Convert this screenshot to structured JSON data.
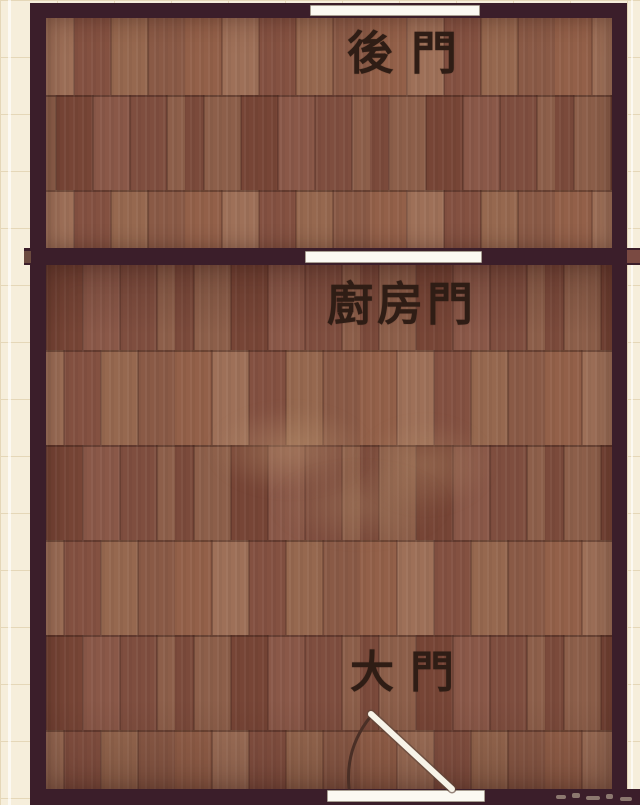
{
  "title": "apartment-floor-plan",
  "labels": {
    "back_door": "後門",
    "kitchen_door": "廚房門",
    "main_door": "大門"
  },
  "colors": {
    "background": "#f6eedb",
    "grid_line": "#e5d7b8",
    "wall": "#3b1e2a",
    "wall_stub": "#7a4a42",
    "floor_base": "#8a5a46",
    "door_opening": "#fbf9f2",
    "swing_arc": "#4a2f26",
    "label_text": "#2f1d15"
  }
}
